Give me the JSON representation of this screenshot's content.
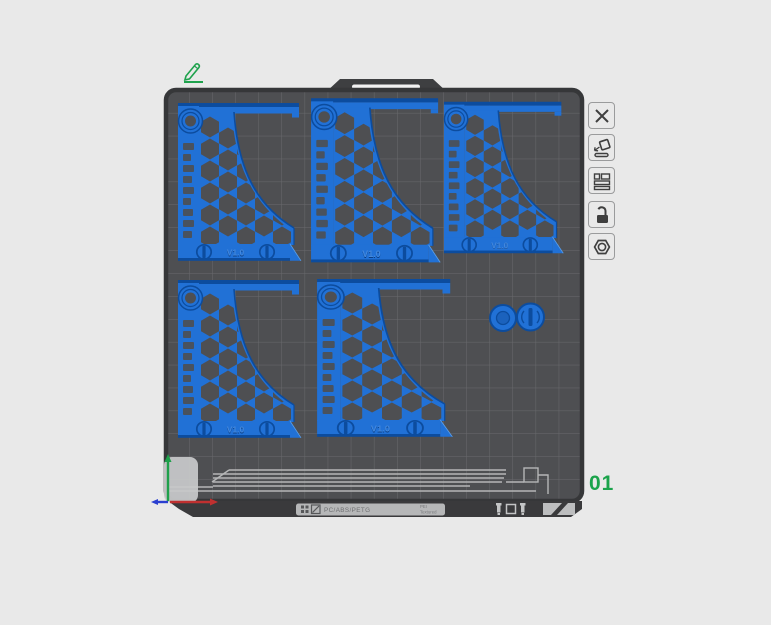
{
  "colors": {
    "background": "#e9e9e9",
    "plate_surface": "#4e4f52",
    "plate_grid": "#696a6d",
    "plate_rim": "#363739",
    "model_blue": "#2171d6",
    "model_blue_dark": "#0c4c9e",
    "accent_green": "#1fa24d"
  },
  "plate": {
    "number": "01",
    "edge_label": {
      "materials_text": "PC/ABS/PETG",
      "side_text_line1": "PEI",
      "side_text_line2": "Textured"
    }
  },
  "models": {
    "bracket_engraving": "V1.0"
  },
  "toolbar": {
    "buttons": [
      {
        "name": "delete-plate"
      },
      {
        "name": "auto-orient"
      },
      {
        "name": "arrange-plate"
      },
      {
        "name": "lock-plate"
      },
      {
        "name": "plate-settings"
      }
    ]
  }
}
